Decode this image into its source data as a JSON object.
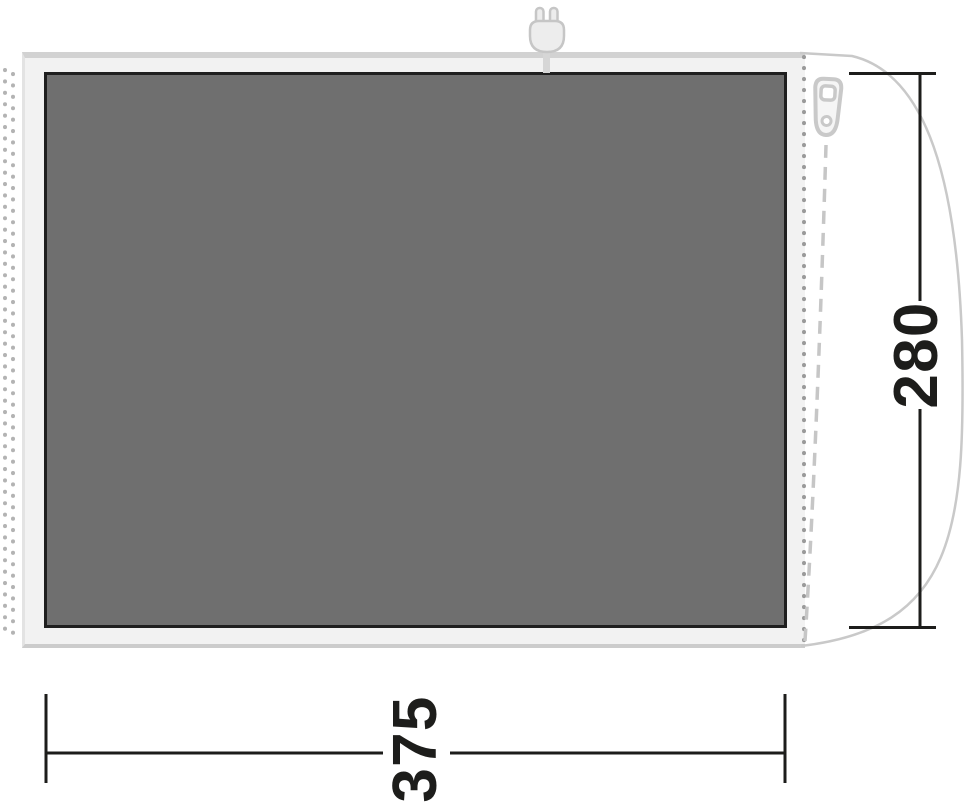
{
  "diagram": {
    "name": "tent-groundsheet-floor-plan",
    "dimensions": {
      "width": {
        "value": "375",
        "position": "bottom"
      },
      "height": {
        "value": "280",
        "position": "right"
      }
    },
    "icons": {
      "plug": "power-plug-icon",
      "zipper": "zipper-pull-icon"
    },
    "colors": {
      "floor_fill": "#6f6f6f",
      "floor_border": "#1f1f1f",
      "groundsheet_fill": "#f2f2f2",
      "outline_gray": "#c9c9c9",
      "dimension_ink": "#1d1d1b"
    }
  }
}
